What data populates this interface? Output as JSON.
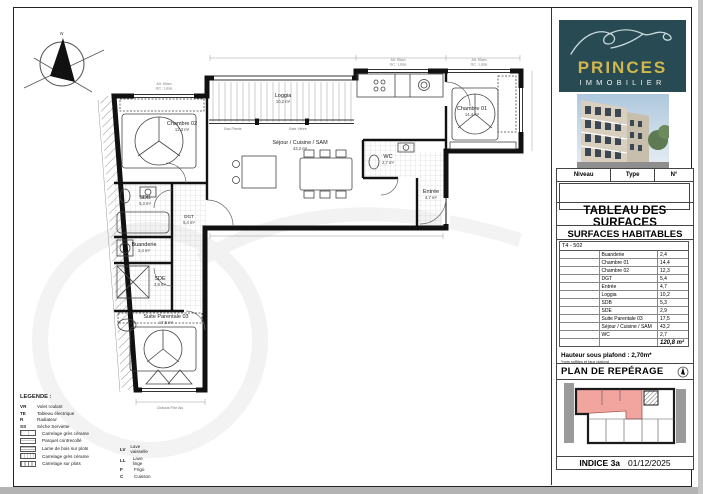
{
  "page": {
    "compass": "N"
  },
  "plan": {
    "rooms": {
      "chambre02": {
        "name": "Chambre 02",
        "area": "12,3 m²"
      },
      "chambre01": {
        "name": "Chambre 01",
        "area": "14,4 m²"
      },
      "loggia": {
        "name": "Loggia",
        "area": "10,2 m²"
      },
      "sejour": {
        "name": "Séjour / Cuisine / SAM",
        "area": "43,2 m²"
      },
      "wc": {
        "name": "WC",
        "area": "2,7 m²"
      },
      "entree": {
        "name": "Entrée",
        "area": "4,7 m²"
      },
      "sdb": {
        "name": "SDB",
        "area": "5,3 m²"
      },
      "dgt": {
        "name": "DGT",
        "area": "5,4 m²"
      },
      "buanderie": {
        "name": "Buanderie",
        "area": "2,4 m²"
      },
      "sde": {
        "name": "SDE",
        "area": "2,9 m²"
      },
      "suite": {
        "name": "Suite Parentale 03",
        "area": "17,5 m²"
      }
    },
    "notes": {
      "alt": "Alt. 90cm",
      "gc": "GC : Lisse",
      "chassis": "Châssis Fixe Alu",
      "bac": "Bac Planté",
      "baie": "Baie Vitrée"
    }
  },
  "legend": {
    "title": "LEGENDE :",
    "abbrev": [
      {
        "c": "VR",
        "l": "Volet roulant"
      },
      {
        "c": "TE",
        "l": "Tableau électrique"
      },
      {
        "c": "R",
        "l": "Radiateur"
      },
      {
        "c": "SS",
        "l": "Sèche Serviette"
      }
    ],
    "floors": [
      "Carrelage grès cérame",
      "Parquet contrecollé",
      "Lame de bois sur plots",
      "Carrelage grès cérame",
      "Carrelage sur plots"
    ],
    "appliances": [
      {
        "c": "LV",
        "l": "Lave vaisselle"
      },
      {
        "c": "LL",
        "l": "Lave linge"
      },
      {
        "c": "F",
        "l": "Frigo"
      },
      {
        "c": "C",
        "l": "Cuisson"
      }
    ]
  },
  "sidebar": {
    "brand": {
      "name": "PRINCES",
      "sub": "IMMOBILIER"
    },
    "unit_header": [
      "Niveau",
      "Type",
      "N°"
    ],
    "surfaces": {
      "title": "TABLEAU DES SURFACES",
      "subtitle": "SURFACES HABITABLES",
      "unit": "T4 - 502",
      "rows": [
        {
          "label": "Buanderie",
          "value": "2,4"
        },
        {
          "label": "Chambre 01",
          "value": "14,4"
        },
        {
          "label": "Chambre 02",
          "value": "12,3"
        },
        {
          "label": "DGT",
          "value": "5,4"
        },
        {
          "label": "Entrée",
          "value": "4,7"
        },
        {
          "label": "Loggia",
          "value": "10,2"
        },
        {
          "label": "SDB",
          "value": "5,3"
        },
        {
          "label": "SDE",
          "value": "2,9"
        },
        {
          "label": "Suite Parentale 03",
          "value": "17,5"
        },
        {
          "label": "Séjour / Cuisine / SAM",
          "value": "43,2"
        },
        {
          "label": "WC",
          "value": "2,7"
        }
      ],
      "total": "120,8 m²"
    },
    "ceiling": {
      "line": "Hauteur sous plafond : 2,70m*",
      "note": "*hors soffites et faux plafond"
    },
    "reperage_title": "PLAN DE REPÉRAGE",
    "footer": {
      "indice": "INDICE 3a",
      "date": "01/12/2025"
    }
  }
}
